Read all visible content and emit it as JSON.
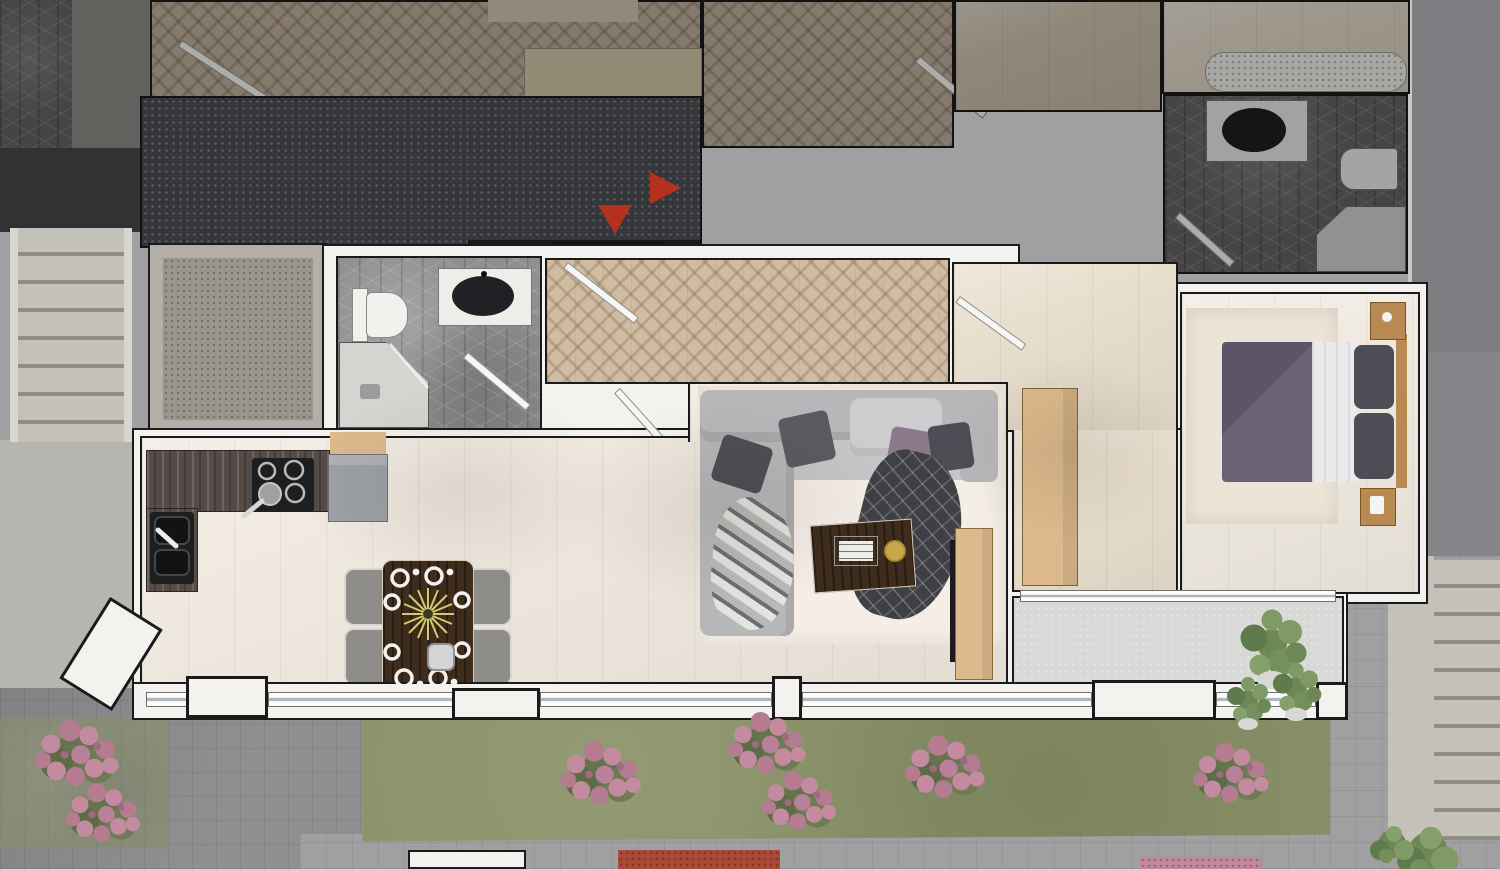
{
  "meta": {
    "type": "architectural floor plan render",
    "view": "top-down 3D visualization",
    "width_px": 1500,
    "height_px": 869,
    "visible_text": "none"
  },
  "annotations": {
    "entrance_arrows": {
      "count": 2,
      "directions": [
        "down",
        "right"
      ],
      "color_key": "arrow_red"
    }
  },
  "rooms": [
    {
      "name": "common-corridor",
      "floor": "dark stone"
    },
    {
      "name": "staircase",
      "floor": "concrete steps"
    },
    {
      "name": "elevator-shaft",
      "floor": "speckled concrete"
    },
    {
      "name": "entrance-hall",
      "floor": "herringbone parquet",
      "fixtures": [
        "entry-door"
      ]
    },
    {
      "name": "bathroom",
      "floor": "hexagonal gray tile",
      "fixtures": [
        "toilet",
        "washbasin-vanity",
        "corner-shower",
        "door"
      ]
    },
    {
      "name": "living-kitchen",
      "floor": "light plank",
      "fixtures": [
        "kitchen-counter",
        "cooktop",
        "sink",
        "refrigerator",
        "dining-table",
        "chairs",
        "sofa",
        "coffee-table",
        "tv-cabinet",
        "rug"
      ]
    },
    {
      "name": "bedroom-hall",
      "floor": "light plank",
      "fixtures": [
        "wardrobe",
        "door"
      ]
    },
    {
      "name": "bedroom",
      "floor": "light plank",
      "fixtures": [
        "double-bed",
        "nightstand",
        "nightstand",
        "rug"
      ]
    },
    {
      "name": "balcony",
      "floor": "pale concrete",
      "fixtures": [
        "potted-plant",
        "sliding-door"
      ]
    },
    {
      "name": "neighbor-room-herringbone",
      "dimmed": true
    },
    {
      "name": "neighbor-room-bed",
      "dimmed": true
    },
    {
      "name": "neighbor-room-wood",
      "dimmed": true
    },
    {
      "name": "neighbor-bathroom",
      "dimmed": true,
      "fixtures": [
        "washbasin-vanity",
        "toilet",
        "corner-shower"
      ]
    }
  ],
  "exterior": {
    "landscaping": [
      "lawn-strip",
      "pink-flower-bushes",
      "green-shrubs",
      "flower-beds"
    ],
    "hardscape": [
      "paved-walkways",
      "exterior-steps",
      "building-side-wall"
    ],
    "pink_bush_count": 6
  },
  "palette": {
    "outline": "#1a1a1a",
    "wall": "#f3f2ef",
    "corridor": "#4b4d53",
    "vestibule": "#222327",
    "arrow_red": "#b5301f",
    "herringbone_dim": "#c0ae97",
    "herringbone_bright": "#cfbca3",
    "wood_floor_dim": "#cfc1a9",
    "hex_dim": "#636367",
    "hex_bright": "#8f8f91",
    "floor_main": "#efe8de",
    "floor_warm": "#e8decd",
    "rug_living": "#f4eee6",
    "rug_bed": "#ebe4d7",
    "counter": "#564c47",
    "black_appliance": "#1d1e20",
    "appliance_gray": "#9da0a5",
    "wood_light": "#ddba8c",
    "wood_mid": "#b98a52",
    "table_dark": "#3e2c1d",
    "chair_gray": "#8f8d8a",
    "sofa": "#b7b7b9",
    "sofa_light": "#c6c6c8",
    "pillow_dark": "#4d4d55",
    "pillow_purple": "#8a7a8c",
    "blanket_dark": "#3f4046",
    "bed_white": "#eaeaec",
    "bed_purple": "#6a6276",
    "stair": "#c4c1b9",
    "stair_dark": "#8f8d86",
    "elevator": "#9b968c",
    "landing": "#b7b5af",
    "paving": "#a0a0a3",
    "paving_dark": "#909093",
    "grass": "#8a9268",
    "flower_pink": "#c2879b",
    "flower_red": "#a84a38",
    "plant_green": "#6d8757",
    "plant_light": "#86a06b",
    "centerpiece": "#d2cb6c",
    "balcony": "#d8d8d6",
    "glass": "#aab4ba",
    "building_side": "#85858a"
  }
}
